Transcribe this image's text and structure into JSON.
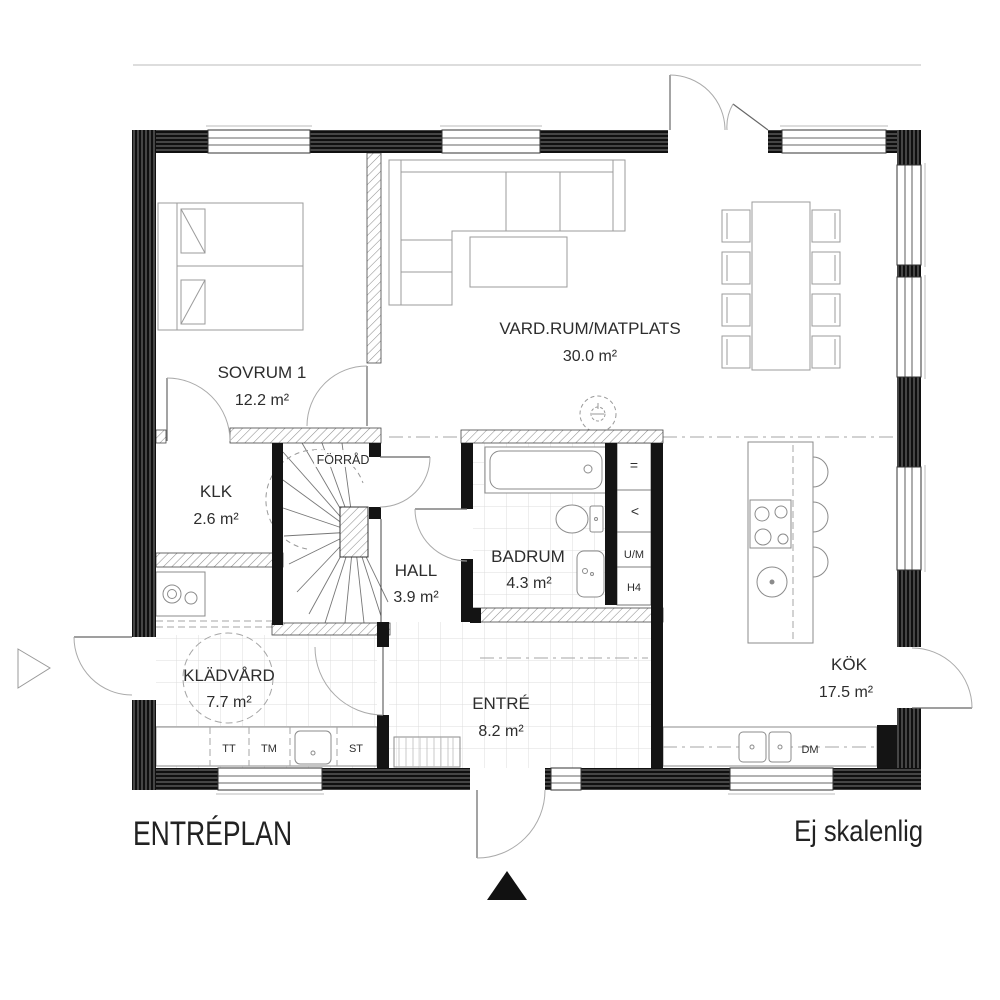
{
  "plan": {
    "title": "ENTRÉPLAN",
    "scale_note": "Ej skalenlig"
  },
  "rooms": {
    "sovrum": {
      "name": "SOVRUM 1",
      "area": "12.2 m²"
    },
    "vardagsrum": {
      "name": "VARD.RUM/MATPLATS",
      "area": "30.0 m²"
    },
    "klk": {
      "name": "KLK",
      "area": "2.6 m²"
    },
    "forrad": {
      "name": "FÖRRÅD"
    },
    "hall": {
      "name": "HALL",
      "area": "3.9 m²"
    },
    "badrum": {
      "name": "BADRUM",
      "area": "4.3 m²"
    },
    "kok": {
      "name": "KÖK",
      "area": "17.5 m²"
    },
    "kladvard": {
      "name": "KLÄDVÅRD",
      "area": "7.7 m²"
    },
    "entre": {
      "name": "ENTRÉ",
      "area": "8.2 m²"
    }
  },
  "appliances": {
    "tt": "TT",
    "tm": "TM",
    "st": "ST",
    "dm": "DM"
  },
  "closet": {
    "um": "U/M",
    "h4": "H4",
    "shelf_symbol": "=",
    "rail_symbol": "<"
  },
  "colors": {
    "wall": "#141414",
    "hatch": "#8f8f8f",
    "furniture": "#9b9b9b",
    "text": "#2d2d2d",
    "tile": "#dcdcdc"
  }
}
